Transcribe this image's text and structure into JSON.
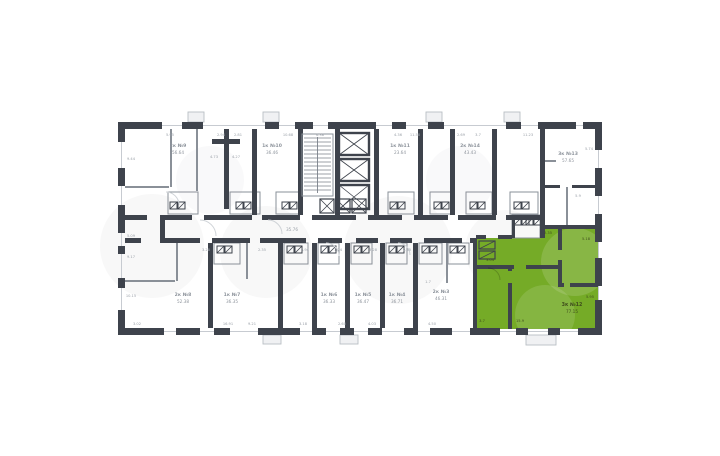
{
  "palette": {
    "background": "#ffffff",
    "wall": "#3e434c",
    "partition": "#8a9098",
    "faint_line": "#c7cbd1",
    "green": "#75ab27",
    "tab_fill": "#f0f1f3",
    "tab_stroke": "#b9bec5",
    "label_gray": "#8f959d",
    "label_on_green": "#3f4d1c",
    "watermark": "rgba(70,78,88,0.04)"
  },
  "plan": {
    "corridor_area": "35.76",
    "selected_unit": {
      "type_label": "3к №12",
      "area": "77.15"
    },
    "units": [
      {
        "label": "2к №9",
        "area": "56.64",
        "x": 178,
        "y": 147
      },
      {
        "label": "1к №10",
        "area": "36.46",
        "x": 272,
        "y": 147
      },
      {
        "label": "1к №11",
        "area": "23.64",
        "x": 400,
        "y": 147
      },
      {
        "label": "2к №14",
        "area": "43.43",
        "x": 470,
        "y": 147
      },
      {
        "label": "3к №13",
        "area": "57.65",
        "x": 568,
        "y": 155
      },
      {
        "label": "2к №8",
        "area": "52.38",
        "x": 183,
        "y": 296
      },
      {
        "label": "1к №7",
        "area": "36.35",
        "x": 232,
        "y": 296
      },
      {
        "label": "1к №6",
        "area": "36.33",
        "x": 329,
        "y": 296
      },
      {
        "label": "1к №5",
        "area": "36.47",
        "x": 363,
        "y": 296
      },
      {
        "label": "1к №4",
        "area": "36.71",
        "x": 397,
        "y": 296
      },
      {
        "label": "2к №3",
        "area": "46.31",
        "x": 441,
        "y": 293
      }
    ],
    "dims": [
      {
        "t": "5.95",
        "x": 170,
        "y": 136
      },
      {
        "t": "2.94",
        "x": 221,
        "y": 136
      },
      {
        "t": "2.81",
        "x": 238,
        "y": 136
      },
      {
        "t": "10.68",
        "x": 288,
        "y": 136
      },
      {
        "t": "6.38",
        "x": 320,
        "y": 136
      },
      {
        "t": "4.36",
        "x": 398,
        "y": 136
      },
      {
        "t": "11.58",
        "x": 415,
        "y": 136
      },
      {
        "t": "2.69",
        "x": 461,
        "y": 136
      },
      {
        "t": "3.7",
        "x": 478,
        "y": 136
      },
      {
        "t": "11.23",
        "x": 528,
        "y": 136
      },
      {
        "t": "5.74",
        "x": 589,
        "y": 150
      },
      {
        "t": "9.44",
        "x": 131,
        "y": 160
      },
      {
        "t": "5.09",
        "x": 131,
        "y": 237
      },
      {
        "t": "9.17",
        "x": 131,
        "y": 258
      },
      {
        "t": "10.15",
        "x": 131,
        "y": 297
      },
      {
        "t": "3.02",
        "x": 137,
        "y": 325
      },
      {
        "t": "16.91",
        "x": 228,
        "y": 325
      },
      {
        "t": "9.21",
        "x": 252,
        "y": 325
      },
      {
        "t": "3.18",
        "x": 303,
        "y": 325
      },
      {
        "t": "2.60",
        "x": 342,
        "y": 325
      },
      {
        "t": "4.03",
        "x": 372,
        "y": 325
      },
      {
        "t": "4.50",
        "x": 432,
        "y": 325
      },
      {
        "t": "4.73",
        "x": 214,
        "y": 158
      },
      {
        "t": "4.27",
        "x": 236,
        "y": 158
      },
      {
        "t": "3.28",
        "x": 206,
        "y": 251
      },
      {
        "t": "2.35",
        "x": 262,
        "y": 251
      },
      {
        "t": "3.94",
        "x": 305,
        "y": 251
      },
      {
        "t": "1.74",
        "x": 338,
        "y": 251
      },
      {
        "t": "3.28",
        "x": 373,
        "y": 251
      },
      {
        "t": "2.35",
        "x": 407,
        "y": 251
      },
      {
        "t": "1.7",
        "x": 428,
        "y": 283
      },
      {
        "t": "5.9",
        "x": 578,
        "y": 197
      },
      {
        "t": "3.04",
        "x": 490,
        "y": 261,
        "g": 1
      },
      {
        "t": "15.9",
        "x": 520,
        "y": 322,
        "g": 1
      },
      {
        "t": "5.18",
        "x": 586,
        "y": 240,
        "g": 1
      },
      {
        "t": "2.35",
        "x": 548,
        "y": 234,
        "g": 1
      },
      {
        "t": "5.95",
        "x": 590,
        "y": 298,
        "g": 1
      },
      {
        "t": "3.7",
        "x": 482,
        "y": 322,
        "g": 1
      }
    ]
  }
}
